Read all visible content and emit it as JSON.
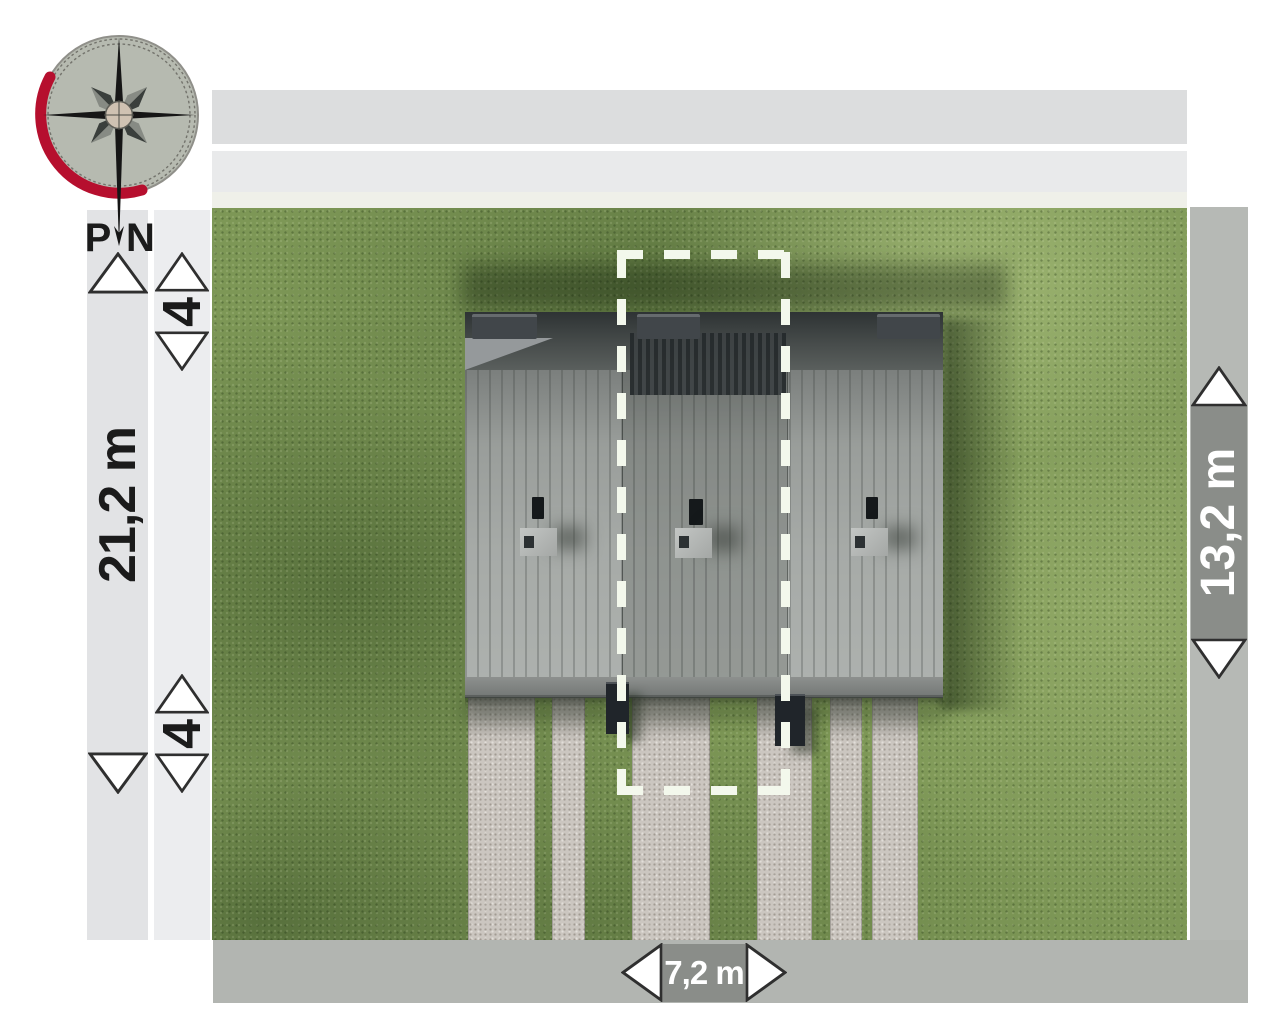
{
  "compass": {
    "west_label": "P",
    "north_label": "N"
  },
  "dimensions": {
    "plot_depth": "21,2 m",
    "front_setback": "4",
    "rear_setback": "4",
    "house_depth": "13,2 m",
    "lot_width": "7,2 m"
  },
  "colors": {
    "page_bg": "#ffffff",
    "grass": "#7d9756",
    "road_top": "#dcddde",
    "road_top2": "#e9eaeb",
    "road": "#b2b5b1",
    "road_right": "#b6b9b5",
    "strip_outer": "#e2e3e5",
    "strip_inner": "#ecedef",
    "paving": "#cbc6c0",
    "roof_mid_shade": "rgba(30,34,32,0.17)",
    "badge": "#8a8d89",
    "badge_text": "#ffffff",
    "label_text": "#1b1b1b",
    "arrow_fill": "#ffffff",
    "arrow_stroke": "#2f2f2f",
    "dash": "#f3f8ec",
    "compass_red": "#b60f2e",
    "compass_face": "#b6bab0"
  }
}
